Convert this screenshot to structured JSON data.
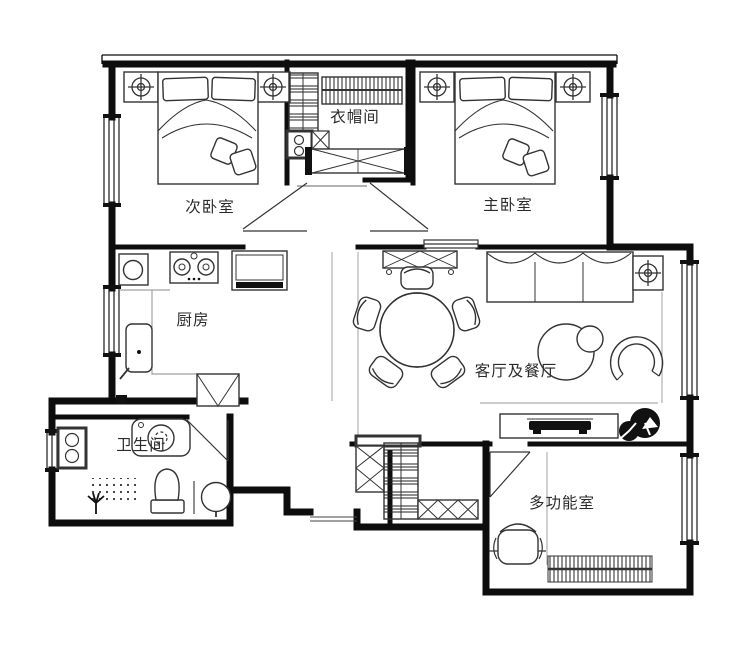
{
  "plan": {
    "type": "apartment-floor-plan",
    "rooms": [
      {
        "id": "secondary-bedroom",
        "label": "次卧室"
      },
      {
        "id": "cloakroom",
        "label": "衣帽间"
      },
      {
        "id": "master-bedroom",
        "label": "主卧室"
      },
      {
        "id": "kitchen",
        "label": "厨房"
      },
      {
        "id": "living-dining",
        "label": "客厅及餐厅"
      },
      {
        "id": "bathroom",
        "label": "卫生间"
      },
      {
        "id": "multipurpose-room",
        "label": "多功能室"
      }
    ],
    "colors": {
      "wall": "#0d0d0d",
      "furniture_line": "#333333",
      "thin_line": "#999999",
      "background": "#ffffff"
    }
  }
}
